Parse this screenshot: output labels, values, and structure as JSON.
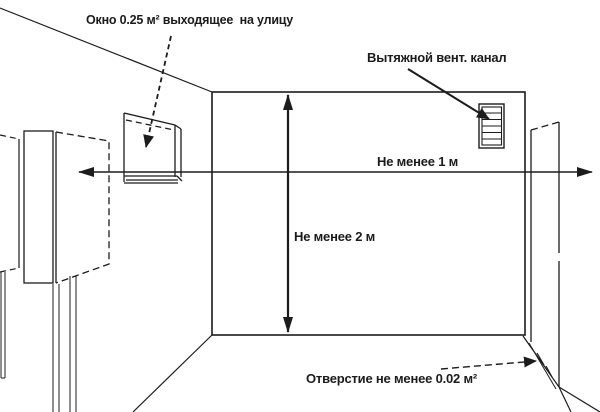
{
  "diagram": {
    "type": "technical-room-sketch",
    "labels": {
      "window": "Окно 0.25 м² выходящее  на улицу",
      "vent": "Вытяжной вент. канал",
      "min_width": "Не менее 1 м",
      "min_height": "Не менее 2 м",
      "opening": "Отверстие не менее 0.02 м²"
    },
    "colors": {
      "line": "#1c1c1c",
      "background": "#ffffff"
    }
  }
}
